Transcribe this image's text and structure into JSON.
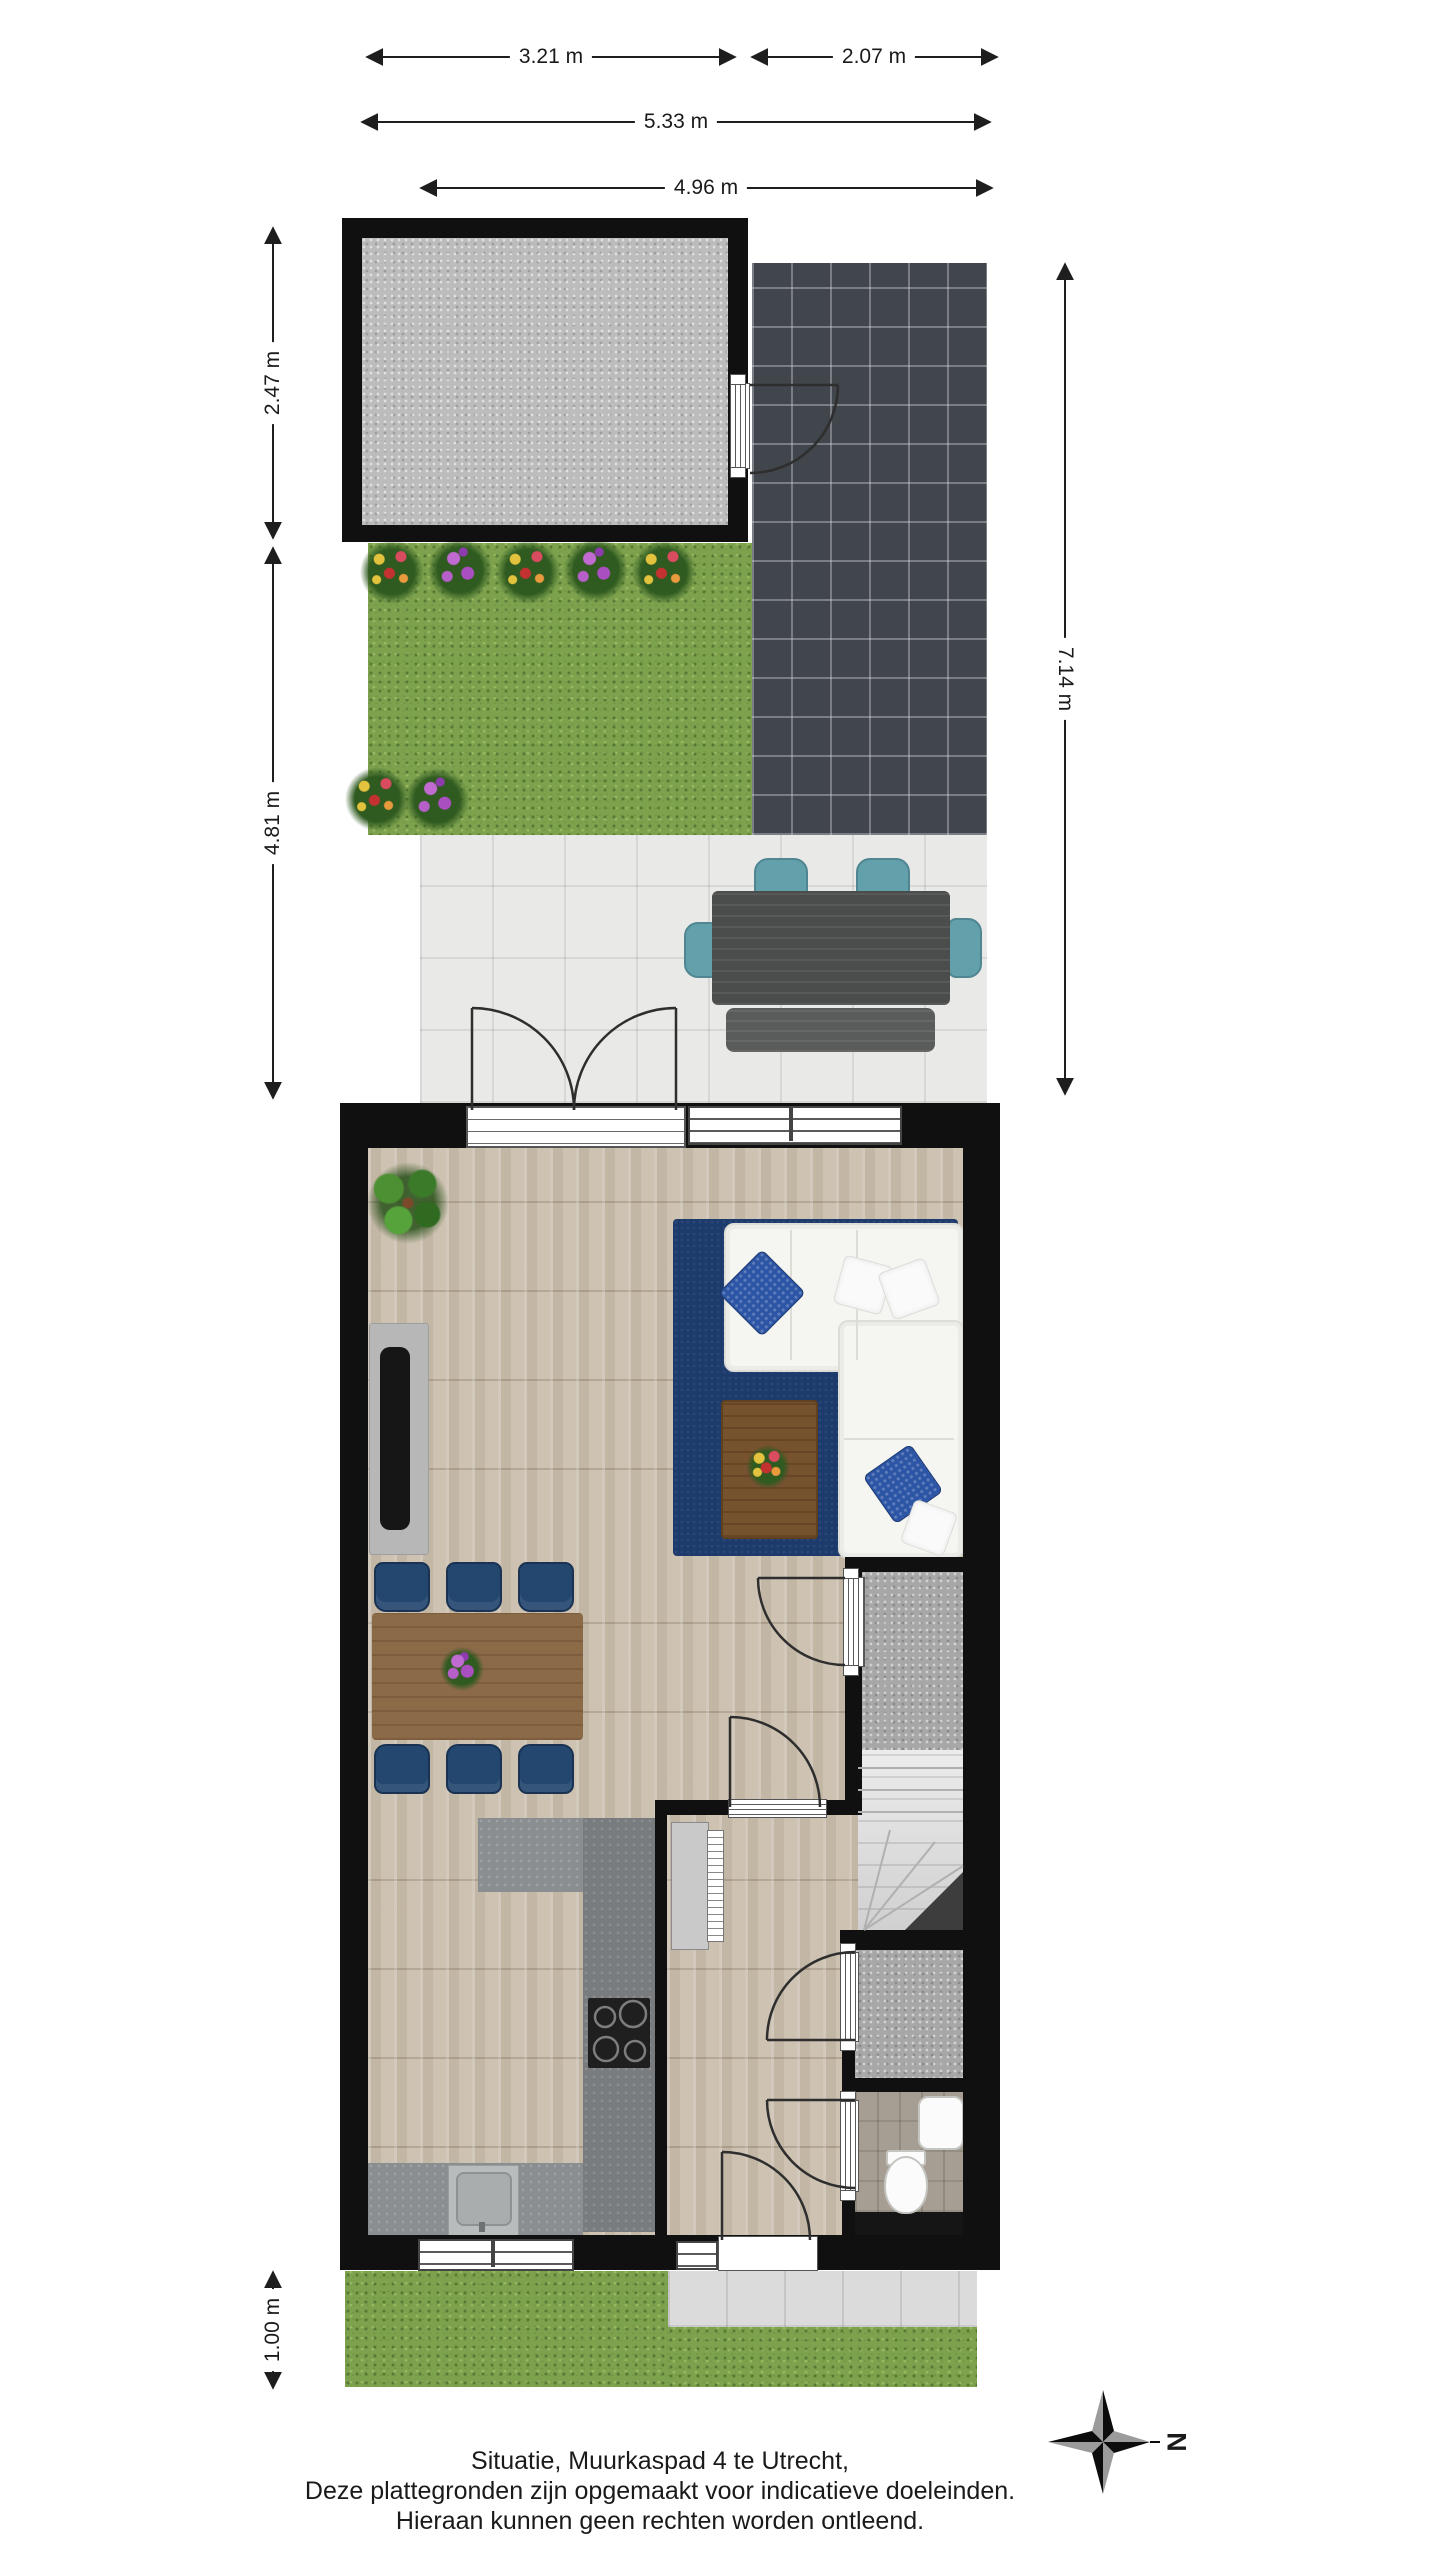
{
  "dimensions": {
    "top": [
      {
        "label": "3.21 m"
      },
      {
        "label": "2.07 m"
      },
      {
        "label": "5.33 m"
      },
      {
        "label": "4.96 m"
      }
    ],
    "left": [
      {
        "label": "2.47 m"
      },
      {
        "label": "4.81 m"
      },
      {
        "label": "1.00 m"
      }
    ],
    "right": [
      {
        "label": "7.14 m"
      }
    ]
  },
  "compass": {
    "north_label": "N"
  },
  "footer": {
    "line1": "Situatie, Muurkaspad 4 te Utrecht,",
    "line2": "Deze plattegronden zijn opgemaakt voor indicatieve doeleinden.",
    "line3": "Hieraan kunnen geen rechten worden ontleend."
  },
  "colors": {
    "wall": "#101010",
    "garage_floor": "#bcbcbc",
    "dark_patio_tile": "#41454c",
    "grass": "#7da24e",
    "terrace_tile": "#e9e9e7",
    "pavement": "#dbdbdb",
    "wood_floor": "#d3c9ba",
    "area_rug": "#1c3a6b",
    "sofa": "#f5f5f2",
    "outdoor_chair": "#62a0ac",
    "dining_chair": "#244770",
    "kitchen_counter": "#8b8e90",
    "stairs": "#d8d8d8",
    "bathroom_floor": "#a69e92"
  }
}
